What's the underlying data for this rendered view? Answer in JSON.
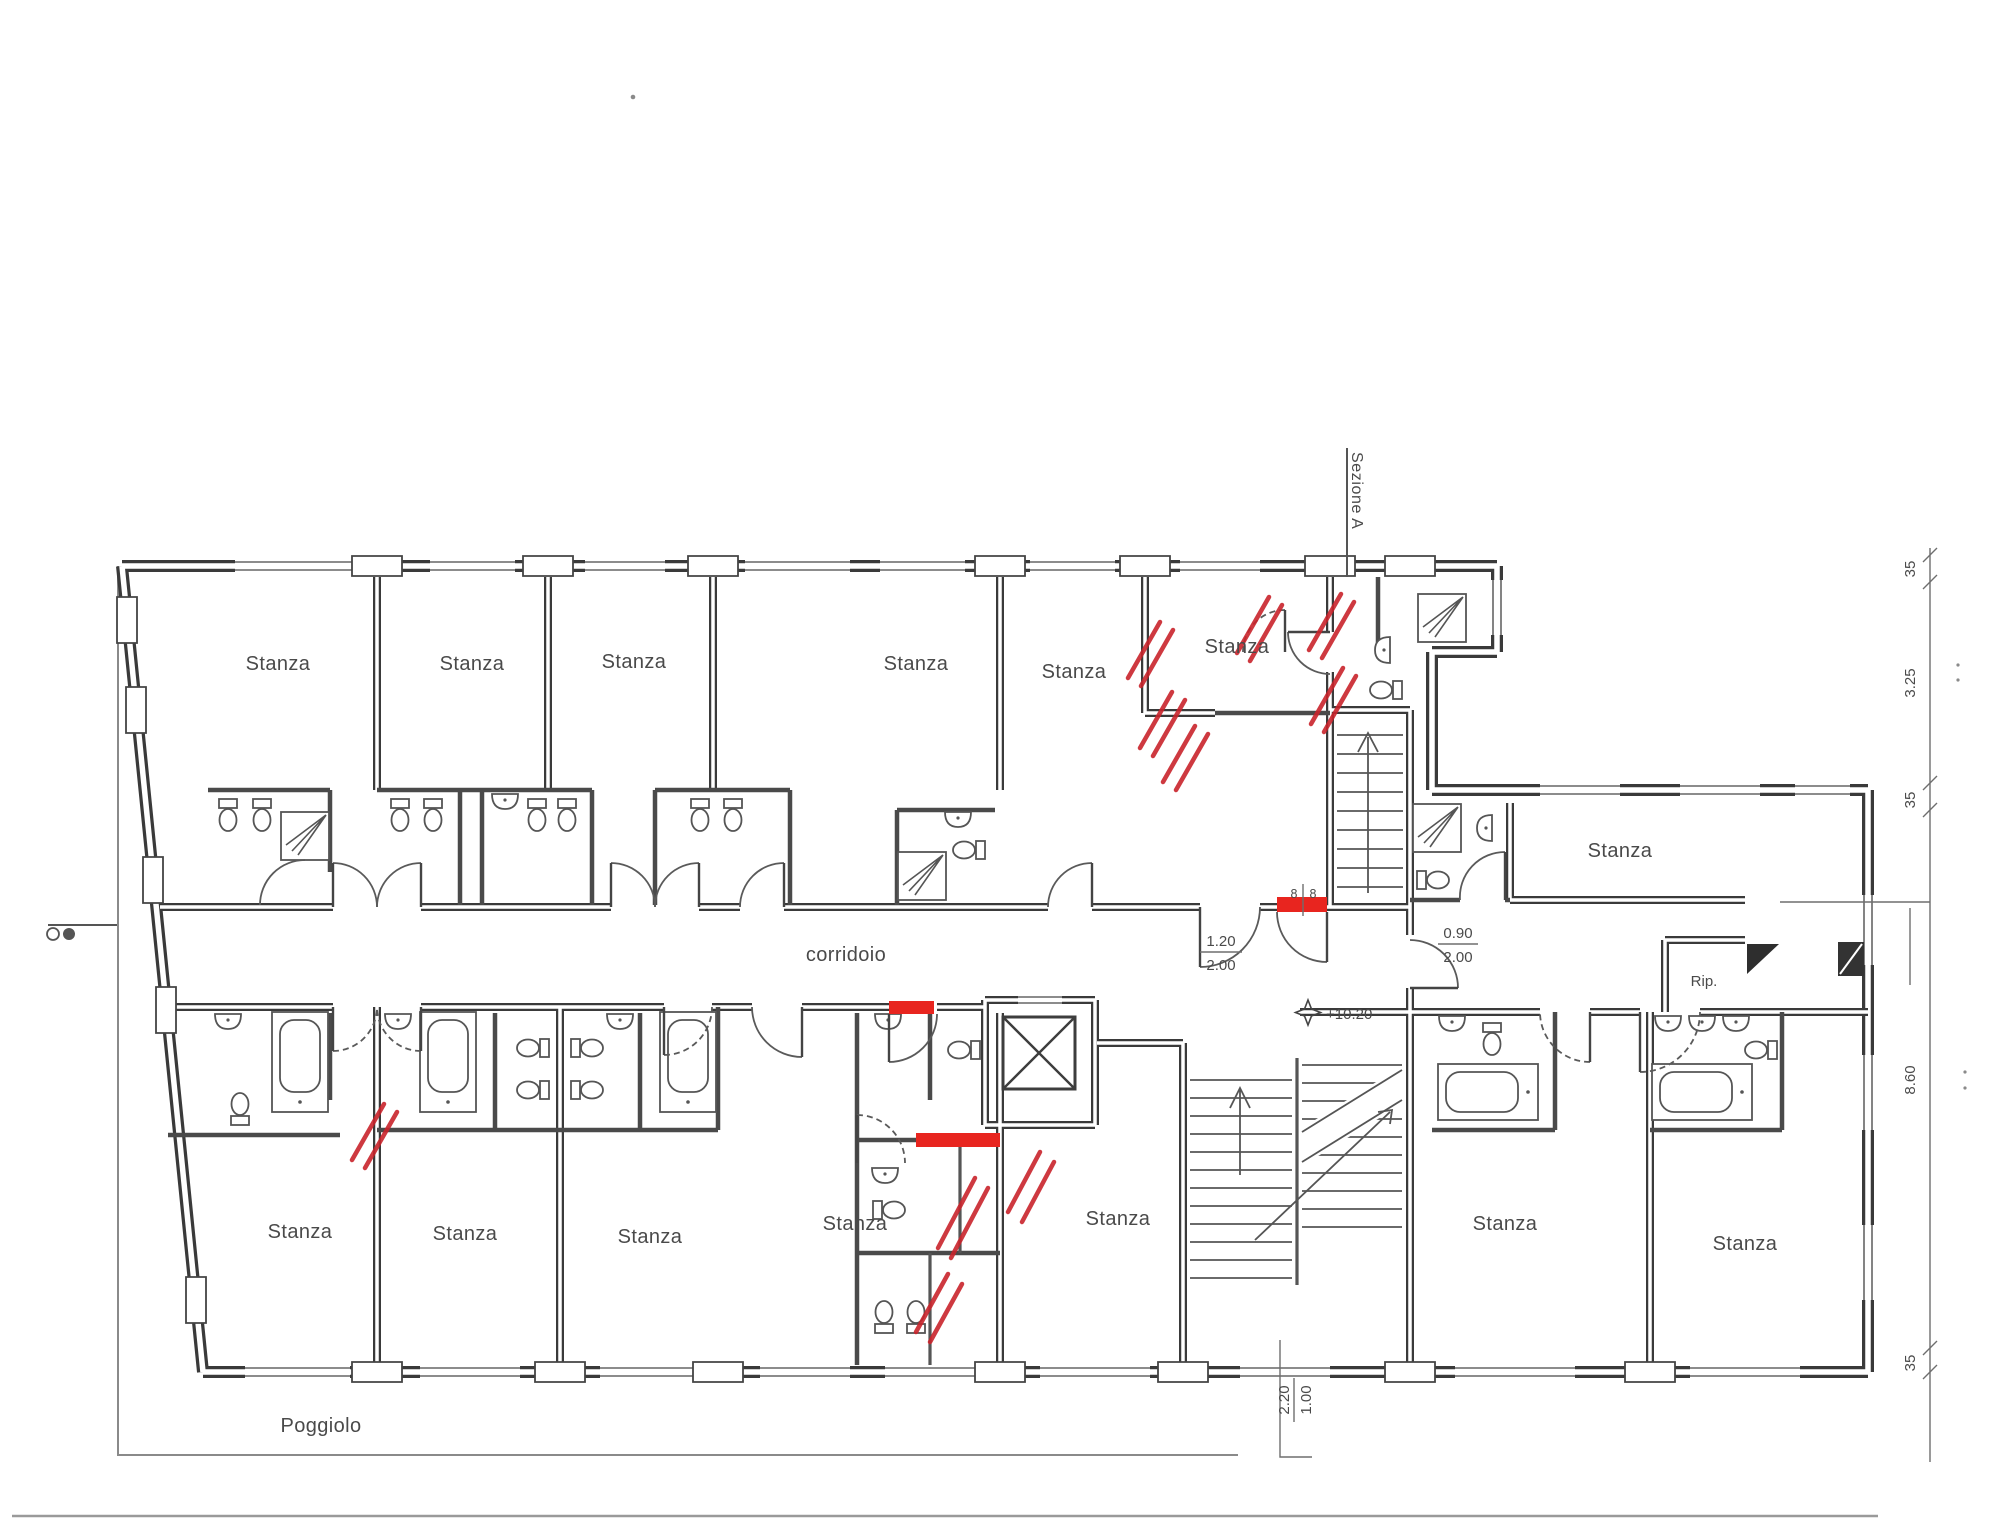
{
  "colors": {
    "demolition_red": "#c9242b",
    "new_work_red": "#e8251f",
    "wall_gray": "#3a3a3a"
  },
  "labels": {
    "room": "Stanza",
    "corridor": "corridoio",
    "balcony": "Poggiolo",
    "storage": "Rip.",
    "section_a": "Sezione A",
    "level_mark": "+10.20"
  },
  "dims": {
    "chain": [
      "35",
      "3.25",
      "35",
      "8.60",
      "35"
    ],
    "door_hall_w": "1.20",
    "door_hall_h": "2.00",
    "door_wing_w": "0.90",
    "door_wing_h": "2.00",
    "entry_w": "2.20",
    "entry_h": "1.00",
    "opening_l": "8",
    "opening_r": "8"
  }
}
